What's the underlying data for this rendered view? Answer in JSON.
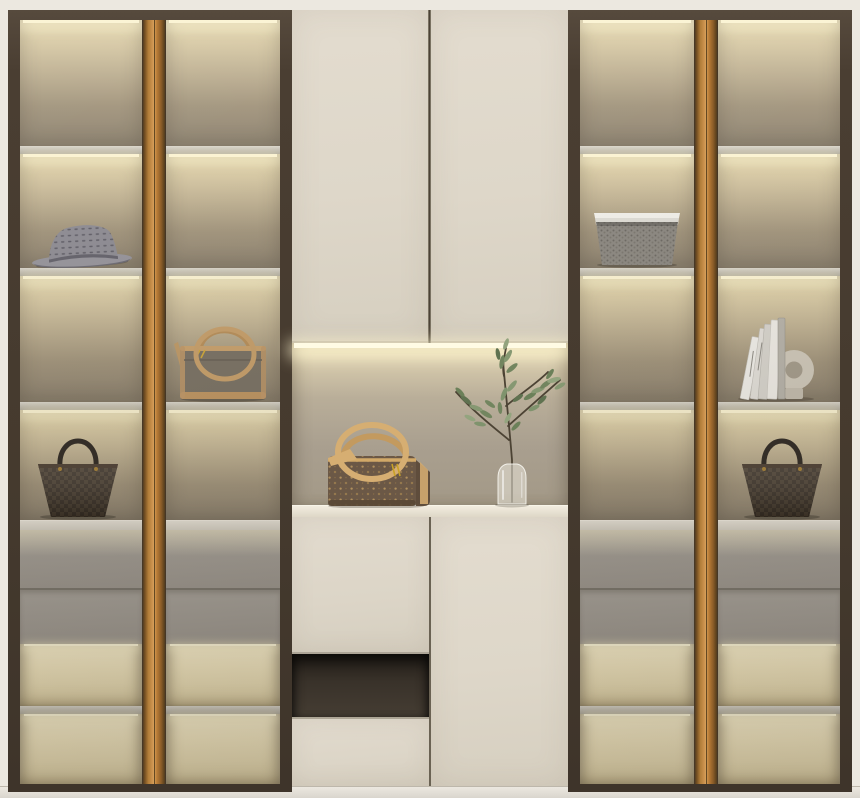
{
  "scene": {
    "title": "Built-in wardrobe display cabinet",
    "description": "Symmetric floor-to-ceiling wardrobe with smoked-glass display columns, brass wood trim strips, warm LED-lit shelves, cream center cabinet with open display niche, gray internal drawers and lit open trays at the bottom."
  },
  "palette": {
    "frame-dark": "#4a3e32",
    "trim-orange": "#cd9450",
    "carcass-cream": "#ece8e0",
    "door-cream": "#ded7c9",
    "glass-warm-top": "#f1e6c2",
    "glass-warm-bottom": "#8d8270",
    "shelf-gray": "#bbb7ae",
    "drawer-gray": "#a8a39b",
    "niche-back": "#a99f8f",
    "open-niche-dark": "#39322a",
    "led-glow": "#fbf3d2",
    "baseboard": "#e4e0d8"
  },
  "sections": {
    "left": {
      "label": "Left glass display section with two doors"
    },
    "center": {
      "label": "Center cream cabinet with lit display niche"
    },
    "right": {
      "label": "Right glass display section with two doors"
    }
  },
  "items": [
    {
      "id": "fedora-hat",
      "label": "Gray perforated fedora hat",
      "location": "left column 1, shelf 2"
    },
    {
      "id": "duffel-bag",
      "label": "Gray duffel bag with tan leather straps",
      "location": "left column 2, shelf 3"
    },
    {
      "id": "damier-tote-left",
      "label": "Dark brown checkered tote bag",
      "location": "left column 1, shelf 4"
    },
    {
      "id": "woven-basket",
      "label": "Gray woven basket with white liner",
      "location": "right column 1, shelf 2"
    },
    {
      "id": "books-and-ring",
      "label": "Leaning books with ring ornament",
      "location": "right column 2, shelf 3"
    },
    {
      "id": "damier-tote-right",
      "label": "Dark brown checkered tote bag",
      "location": "right column 2, shelf 4"
    },
    {
      "id": "monogram-handbag",
      "label": "Brown monogram handbag with tan loop handles",
      "location": "center niche"
    },
    {
      "id": "olive-branch-vase",
      "label": "Glass vase with olive branches",
      "location": "center niche"
    }
  ]
}
